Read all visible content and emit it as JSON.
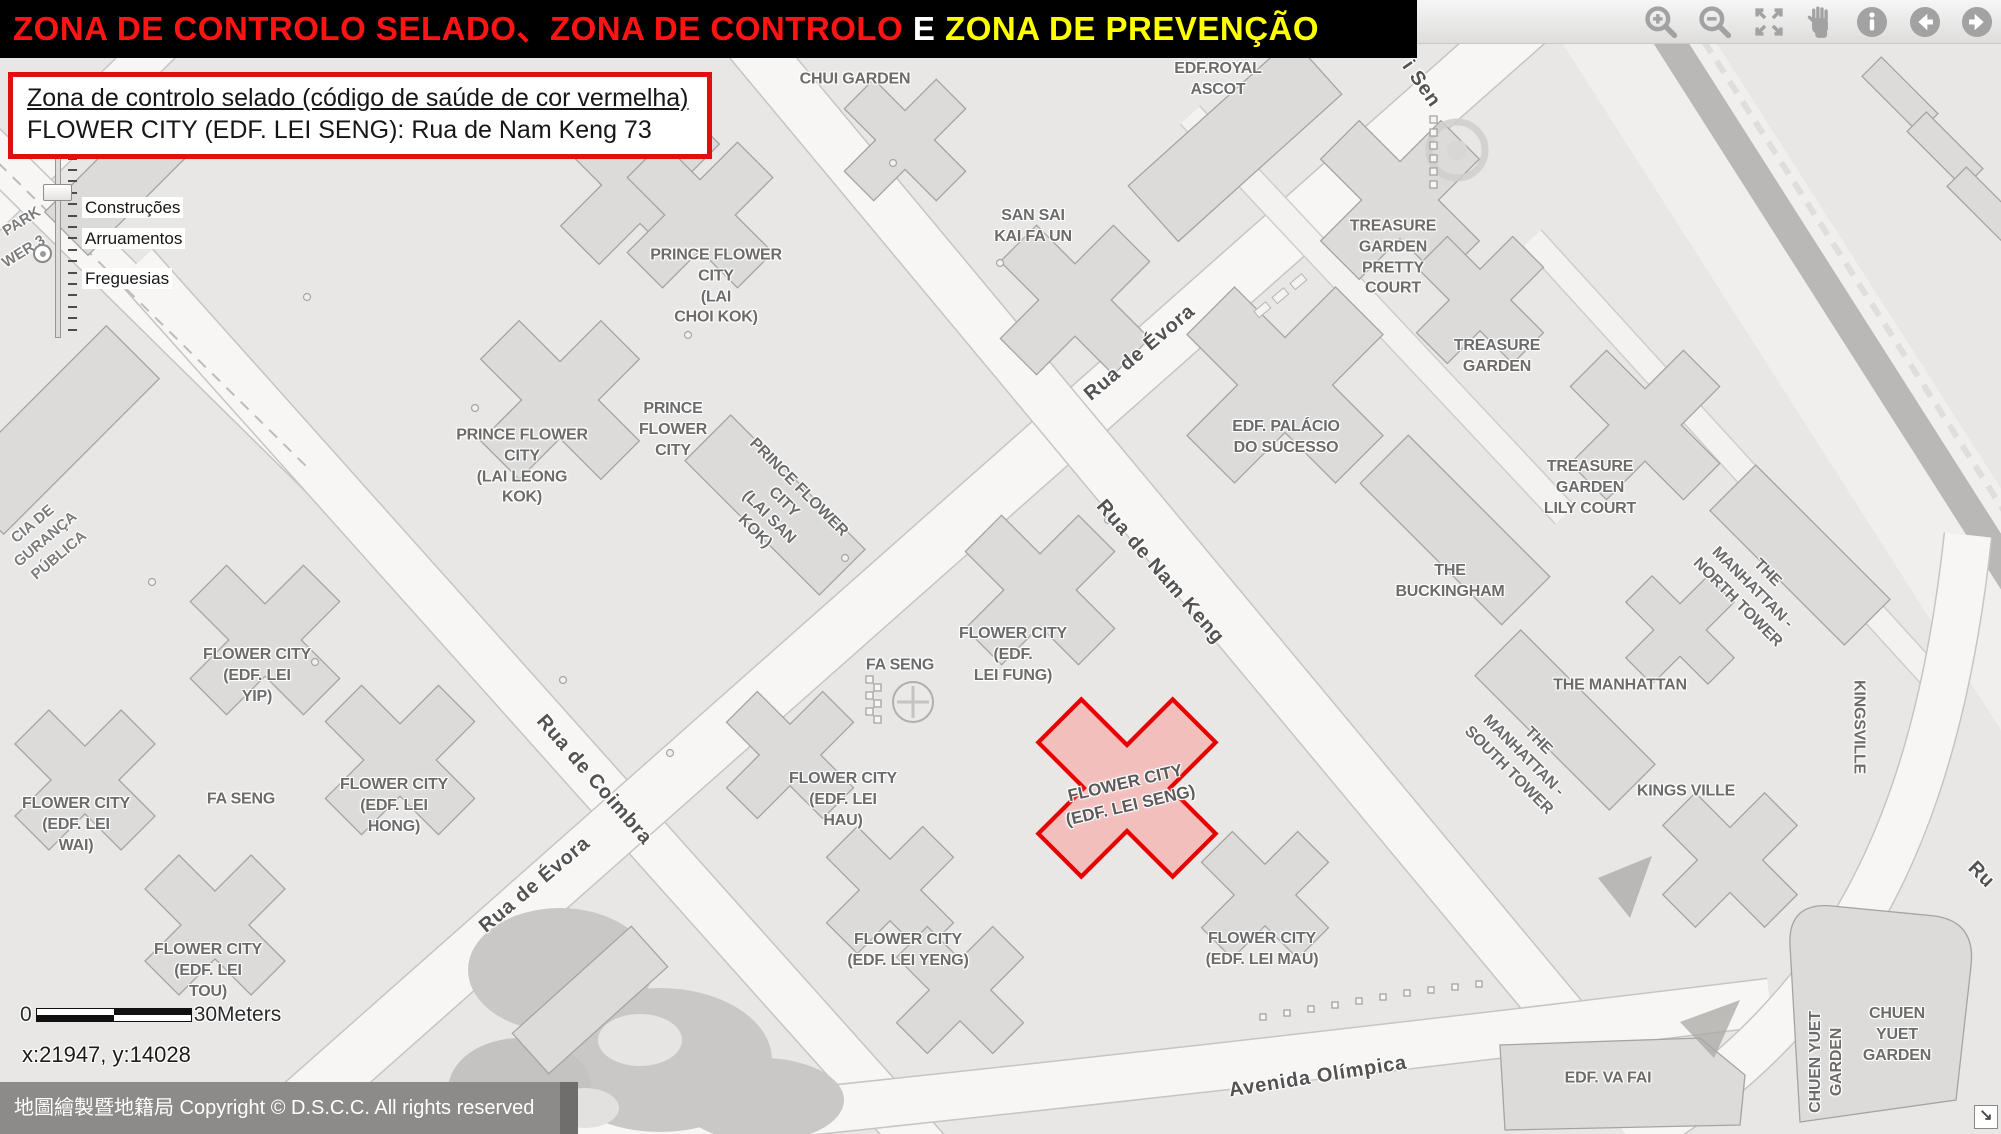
{
  "title": {
    "segments": [
      {
        "text": "ZONA DE CONTROLO SELADO、ZONA DE CONTROLO ",
        "color": "#ff1414"
      },
      {
        "text": "E",
        "color": "#ffffff"
      },
      {
        "text": " ZONA DE PREVENÇÃO",
        "color": "#ffff00"
      }
    ]
  },
  "info_box": {
    "line1": "Zona de controlo selado (código de saúde de cor vermelha)",
    "line2": "FLOWER CITY (EDF. LEI SENG): Rua de Nam Keng 73"
  },
  "legend": {
    "items": [
      "Construções",
      "Arruamentos",
      "Freguesias"
    ]
  },
  "toolbar": {
    "icons": [
      "zoom-in",
      "zoom-out",
      "full-extent",
      "pan",
      "identify",
      "previous-view",
      "next-view"
    ]
  },
  "map": {
    "highlight": {
      "name": "FLOWER CITY (EDF. LEI SENG)",
      "fill": "#f3b9b7",
      "stroke": "#e60000"
    },
    "scale_bar": {
      "start": "0",
      "end": "30Meters"
    },
    "coordinates": "x:21947, y:14028",
    "labels": [
      {
        "t": "CHUI GARDEN",
        "x": 855,
        "y": 80,
        "c": "b"
      },
      {
        "t": "EDF.ROYAL\nASCOT",
        "x": 1218,
        "y": 80,
        "c": "b"
      },
      {
        "t": "SAN SAI\nKAI FA UN",
        "x": 1033,
        "y": 227,
        "c": "b"
      },
      {
        "t": "PRINCE FLOWER\nCITY\n(LAI\nCHOI KOK)",
        "x": 716,
        "y": 287,
        "c": "b"
      },
      {
        "t": "TREASURE\nGARDEN\nPRETTY\nCOURT",
        "x": 1393,
        "y": 258,
        "c": "b"
      },
      {
        "t": "TREASURE\nGARDEN",
        "x": 1497,
        "y": 357,
        "c": "b"
      },
      {
        "t": "EDF. PALÁCIO\nDO SUCESSO",
        "x": 1286,
        "y": 438,
        "c": "b"
      },
      {
        "t": "TREASURE\nGARDEN\nLILY COURT",
        "x": 1590,
        "y": 488,
        "c": "b"
      },
      {
        "t": "THE\nBUCKINGHAM",
        "x": 1450,
        "y": 582,
        "c": "b"
      },
      {
        "t": "PRINCE FLOWER\nCITY\n(LAI LEONG\nKOK)",
        "x": 522,
        "y": 467,
        "c": "b"
      },
      {
        "t": "PRINCE\nFLOWER\nCITY",
        "x": 673,
        "y": 430,
        "c": "b"
      },
      {
        "t": "PRINCE FLOWER\nCITY\n(LAI SAN\nKOK)",
        "x": 776,
        "y": 510,
        "r": 45,
        "c": "b"
      },
      {
        "t": "FA SENG",
        "x": 900,
        "y": 666,
        "c": "b"
      },
      {
        "t": "FLOWER CITY\n(EDF.\nLEI FUNG)",
        "x": 1013,
        "y": 655,
        "c": "b"
      },
      {
        "t": "FLOWER CITY\n(EDF. LEI\nYIP)",
        "x": 257,
        "y": 676,
        "c": "b"
      },
      {
        "t": "FLOWER CITY\n(EDF. LEI\nWAI)",
        "x": 76,
        "y": 825,
        "c": "b"
      },
      {
        "t": "FA SENG",
        "x": 241,
        "y": 800,
        "c": "b"
      },
      {
        "t": "FLOWER CITY\n(EDF. LEI\nHONG)",
        "x": 394,
        "y": 806,
        "c": "b"
      },
      {
        "t": "FLOWER CITY\n(EDF. LEI\nHAU)",
        "x": 843,
        "y": 800,
        "c": "b"
      },
      {
        "t": "FLOWER CITY\n(EDF. LEI SENG)",
        "x": 1128,
        "y": 795,
        "r": -13,
        "c": "sealed"
      },
      {
        "t": "FLOWER CITY\n(EDF. LEI\nTOU)",
        "x": 208,
        "y": 971,
        "c": "b"
      },
      {
        "t": "FLOWER CITY\n(EDF. LEI YENG)",
        "x": 908,
        "y": 951,
        "c": "b"
      },
      {
        "t": "FLOWER CITY\n(EDF. LEI MAU)",
        "x": 1262,
        "y": 950,
        "c": "b"
      },
      {
        "t": "THE\nMANHATTAN -\nNORTH TOWER",
        "x": 1752,
        "y": 588,
        "r": 45,
        "c": "b"
      },
      {
        "t": "THE MANHATTAN",
        "x": 1620,
        "y": 686,
        "c": "b"
      },
      {
        "t": "THE\nMANHATTAN -\nSOUTH TOWER",
        "x": 1523,
        "y": 756,
        "r": 45,
        "c": "b"
      },
      {
        "t": "KINGS VILLE",
        "x": 1686,
        "y": 792,
        "c": "b"
      },
      {
        "t": "KINGSVILLE",
        "x": 1858,
        "y": 727,
        "r": 90,
        "c": "b"
      },
      {
        "t": "CHUEN YUET\nGARDEN",
        "x": 1827,
        "y": 1062,
        "r": -90,
        "c": "b"
      },
      {
        "t": "CHUEN\nYUET\nGARDEN",
        "x": 1897,
        "y": 1035,
        "c": "b"
      },
      {
        "t": "EDF. VA FAI",
        "x": 1608,
        "y": 1079,
        "c": "b"
      },
      {
        "t": "Rua de Évora",
        "x": 1140,
        "y": 353,
        "r": -40,
        "c": "s"
      },
      {
        "t": "Rua de Nam Keng",
        "x": 1160,
        "y": 572,
        "r": 49,
        "c": "s"
      },
      {
        "t": "Rua de Coimbra",
        "x": 594,
        "y": 780,
        "r": 49,
        "c": "s"
      },
      {
        "t": "Rua de Évora",
        "x": 535,
        "y": 885,
        "r": -40,
        "c": "s"
      },
      {
        "t": "Avenida Olímpica",
        "x": 1318,
        "y": 1077,
        "r": -9,
        "c": "s"
      },
      {
        "t": "i Sen",
        "x": 1421,
        "y": 84,
        "r": 55,
        "c": "s"
      },
      {
        "t": "Ru",
        "x": 1981,
        "y": 875,
        "r": 45,
        "c": "s"
      },
      {
        "t": "PARK",
        "x": 22,
        "y": 222,
        "r": -32,
        "c": "f"
      },
      {
        "t": "WER 3",
        "x": 24,
        "y": 252,
        "r": -32,
        "c": "f"
      },
      {
        "t": "CIA DE\nGURANÇA\nPÚBLICA",
        "x": 46,
        "y": 540,
        "r": -40,
        "c": "f"
      }
    ]
  },
  "footer": {
    "text": "地圖繪製暨地籍局 Copyright © D.S.C.C. All rights reserved",
    "resize_icon": "↘"
  }
}
